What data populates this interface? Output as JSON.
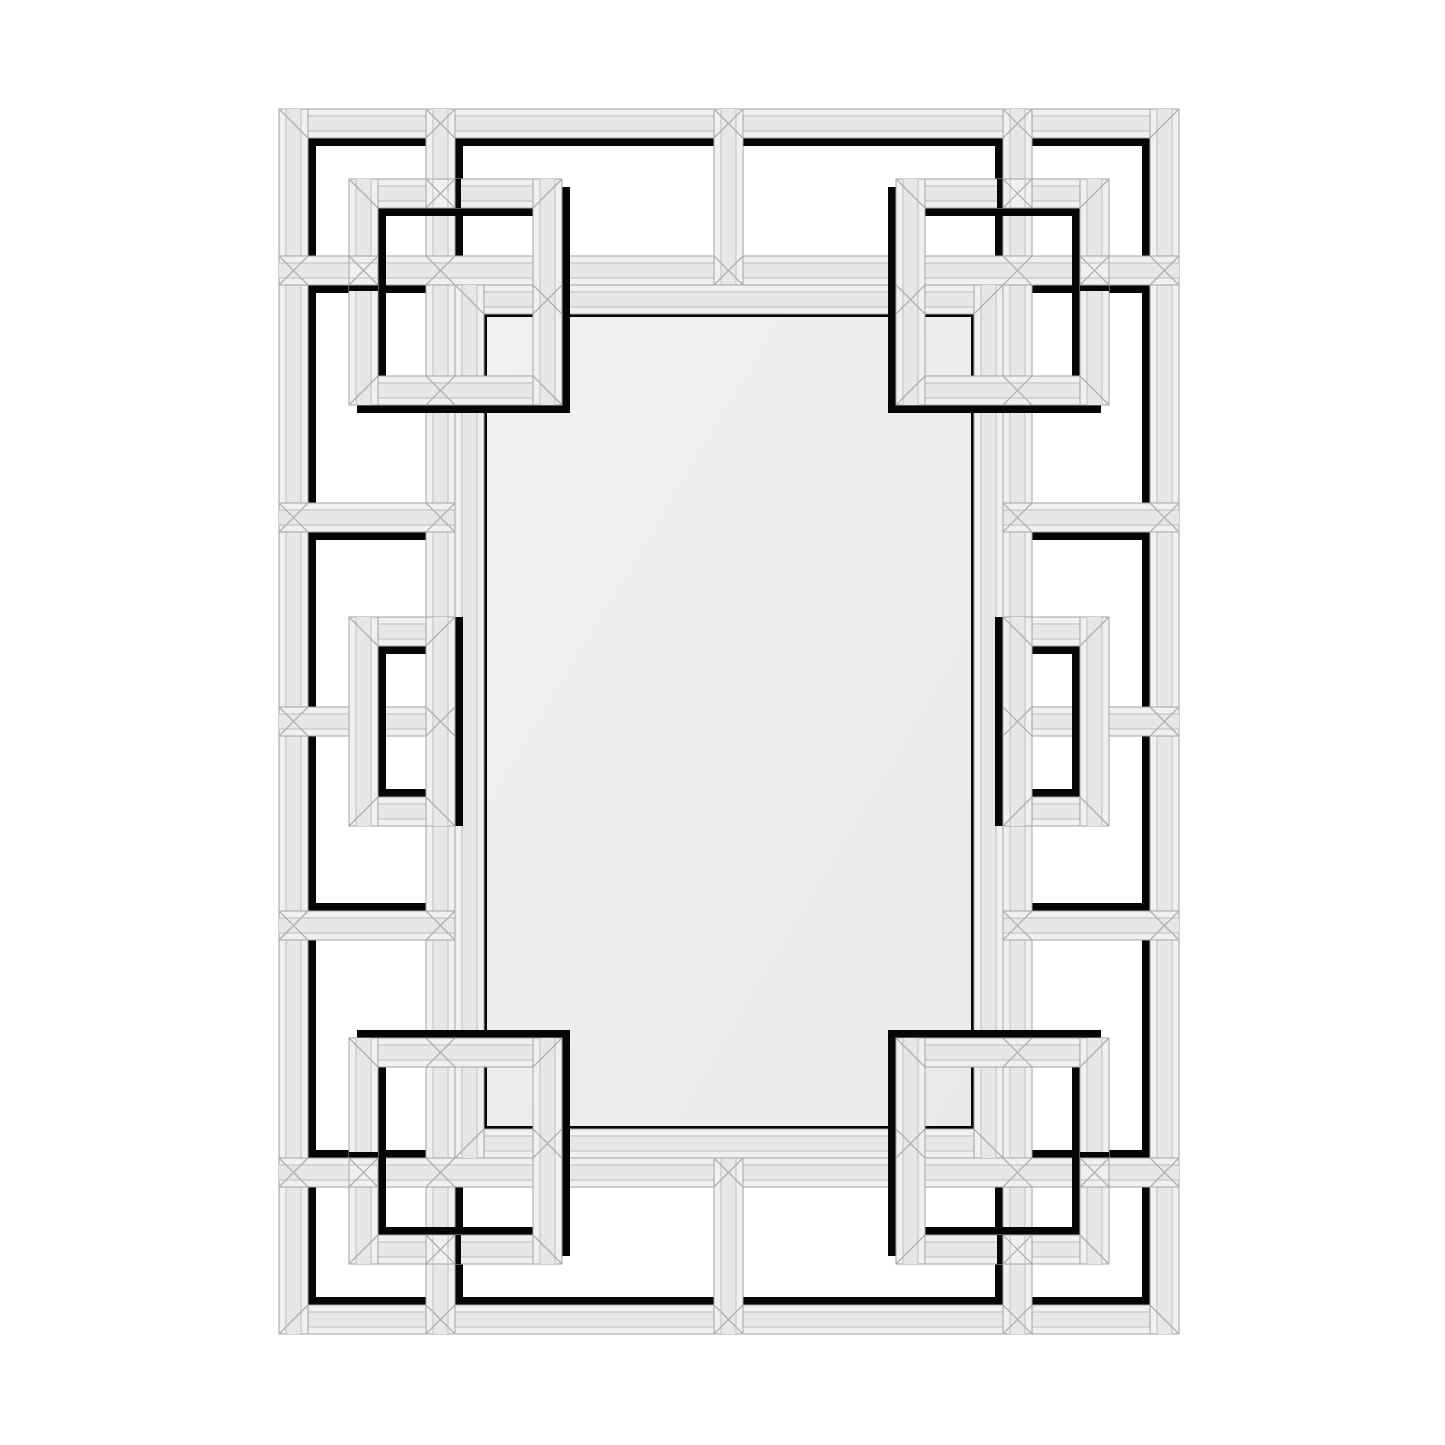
{
  "scene": {
    "kind": "product-photo",
    "subject": "rectangular beveled wall mirror with interlocking Greek-key mirrored fretwork frame",
    "background": "#ffffff"
  },
  "palette": {
    "background": "#ffffff",
    "band_edge": "#f0f0ef",
    "band_core": "#e7e7e6",
    "outline": "#a3a3a2",
    "seam": "#c7c7c6",
    "diag": "#b2b2b1",
    "shadow": "#060606",
    "glass_light": "#f2f1f0",
    "glass_dark": "#e9e9e8",
    "glass_stroke": "#bcbcbb"
  },
  "frame": {
    "band": 29,
    "shadow_size": 8,
    "mirror_shadow_size": 3,
    "patch_shadow_size": 6,
    "center": {
      "x": 729,
      "y": 721.5
    },
    "outer_ring": {
      "x": 279,
      "y": 109,
      "w": 900,
      "h": 1225
    },
    "mirror_ring": {
      "x": 455,
      "y": 285,
      "w": 548,
      "h": 873
    },
    "glass": {
      "x": 484,
      "y": 314,
      "w": 490,
      "h": 815
    },
    "strips": [
      {
        "x": 426,
        "y": 109,
        "w": 29,
        "h": 1225,
        "name": "rail-left"
      },
      {
        "x": 1003,
        "y": 109,
        "w": 29,
        "h": 1225,
        "name": "rail-right"
      },
      {
        "x": 279,
        "y": 256,
        "w": 900,
        "h": 29,
        "name": "rail-top"
      },
      {
        "x": 279,
        "y": 1158,
        "w": 900,
        "h": 29,
        "name": "rail-bottom"
      },
      {
        "x": 714,
        "y": 109,
        "w": 29,
        "h": 176,
        "name": "connector-top-center"
      },
      {
        "x": 714,
        "y": 1158,
        "w": 29,
        "h": 176,
        "name": "connector-bottom-center"
      },
      {
        "x": 279,
        "y": 503,
        "w": 176,
        "h": 29,
        "name": "connector-left-upper"
      },
      {
        "x": 279,
        "y": 707,
        "w": 176,
        "h": 29,
        "name": "connector-left-middle"
      },
      {
        "x": 279,
        "y": 911,
        "w": 176,
        "h": 29,
        "name": "connector-left-lower"
      },
      {
        "x": 1003,
        "y": 503,
        "w": 176,
        "h": 29,
        "name": "connector-right-upper"
      },
      {
        "x": 1003,
        "y": 707,
        "w": 176,
        "h": 29,
        "name": "connector-right-middle"
      },
      {
        "x": 1003,
        "y": 911,
        "w": 176,
        "h": 29,
        "name": "connector-right-lower"
      }
    ],
    "motifs": [
      {
        "x": 349,
        "y": 179,
        "w": 213,
        "h": 226,
        "name": "interlock-square-top-left"
      },
      {
        "x": 896,
        "y": 179,
        "w": 213,
        "h": 226,
        "name": "interlock-square-top-right"
      },
      {
        "x": 349,
        "y": 617,
        "w": 106,
        "h": 209,
        "name": "interlock-square-mid-left"
      },
      {
        "x": 1003,
        "y": 617,
        "w": 106,
        "h": 209,
        "name": "interlock-square-mid-right"
      },
      {
        "x": 349,
        "y": 1038,
        "w": 213,
        "h": 226,
        "name": "interlock-square-bottom-left"
      },
      {
        "x": 896,
        "y": 1038,
        "w": 213,
        "h": 226,
        "name": "interlock-square-bottom-right"
      }
    ],
    "patches": [
      {
        "x": 426,
        "y": 179,
        "dir": "v"
      },
      {
        "x": 349,
        "y": 256,
        "dir": "h"
      },
      {
        "x": 1003,
        "y": 179,
        "dir": "v"
      },
      {
        "x": 1080,
        "y": 256,
        "dir": "h"
      },
      {
        "x": 426,
        "y": 1235,
        "dir": "v"
      },
      {
        "x": 349,
        "y": 1158,
        "dir": "h"
      },
      {
        "x": 1003,
        "y": 1235,
        "dir": "v"
      },
      {
        "x": 1080,
        "y": 1158,
        "dir": "h"
      }
    ],
    "stars": [
      [
        440.5,
        123.5
      ],
      [
        728.5,
        123.5
      ],
      [
        1017.5,
        123.5
      ],
      [
        440.5,
        1319.5
      ],
      [
        728.5,
        1319.5
      ],
      [
        1017.5,
        1319.5
      ],
      [
        293.5,
        270.5
      ],
      [
        293.5,
        517.5
      ],
      [
        293.5,
        721.5
      ],
      [
        293.5,
        925.5
      ],
      [
        293.5,
        1172.5
      ],
      [
        1164.5,
        270.5
      ],
      [
        1164.5,
        517.5
      ],
      [
        1164.5,
        721.5
      ],
      [
        1164.5,
        925.5
      ],
      [
        1164.5,
        1172.5
      ],
      [
        440.5,
        270.5
      ],
      [
        1017.5,
        270.5
      ],
      [
        440.5,
        1172.5
      ],
      [
        1017.5,
        1172.5
      ],
      [
        728.5,
        270.5
      ],
      [
        728.5,
        1172.5
      ],
      [
        440.5,
        517.5
      ],
      [
        440.5,
        721.5
      ],
      [
        440.5,
        925.5
      ],
      [
        1017.5,
        517.5
      ],
      [
        1017.5,
        721.5
      ],
      [
        1017.5,
        925.5
      ],
      [
        440.5,
        193.5
      ],
      [
        440.5,
        390.5
      ],
      [
        1017.5,
        193.5
      ],
      [
        1017.5,
        390.5
      ],
      [
        440.5,
        1052.5
      ],
      [
        440.5,
        1249.5
      ],
      [
        1017.5,
        1052.5
      ],
      [
        1017.5,
        1249.5
      ],
      [
        363.5,
        270.5
      ],
      [
        1094.5,
        270.5
      ],
      [
        363.5,
        1172.5
      ],
      [
        1094.5,
        1172.5
      ],
      [
        547.5,
        299.5
      ],
      [
        910.5,
        299.5
      ],
      [
        547.5,
        1143.5
      ],
      [
        910.5,
        1143.5
      ]
    ]
  }
}
